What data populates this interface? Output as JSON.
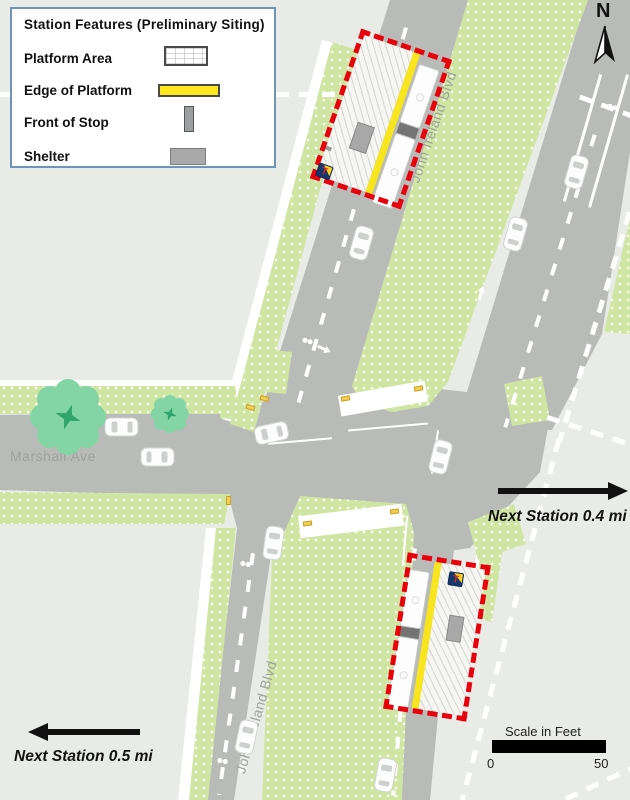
{
  "legend": {
    "title": "Station Features (Preliminary Siting)",
    "items": [
      {
        "label": "Platform Area",
        "swatch": "platform-area"
      },
      {
        "label": "Edge of Platform",
        "swatch": "edge-of-platform"
      },
      {
        "label": "Front of Stop",
        "swatch": "front-of-stop"
      },
      {
        "label": "Shelter",
        "swatch": "shelter"
      }
    ]
  },
  "labels": {
    "north": "N",
    "street_upper_diagonal": "John Ireland Blvd",
    "street_lower_diagonal": "John Ireland Blvd",
    "street_horizontal": "Marshall Ave",
    "next_station_east": "Next Station 0.4 mi",
    "next_station_west": "Next Station 0.5 mi"
  },
  "scale_bar": {
    "title": "Scale in Feet",
    "min": "0",
    "max": "50"
  },
  "station_logo_letter": "T",
  "colors": {
    "background": "#e9ebe6",
    "road": "#b9bbb8",
    "grass": "#cfe5a2",
    "tree": "#83d5a5",
    "station_outline_red": "#e8000b",
    "platform_edge_yellow": "#f8e51d",
    "shelter_gray": "#a7a8a7",
    "legend_border_blue": "#6f94b8"
  }
}
